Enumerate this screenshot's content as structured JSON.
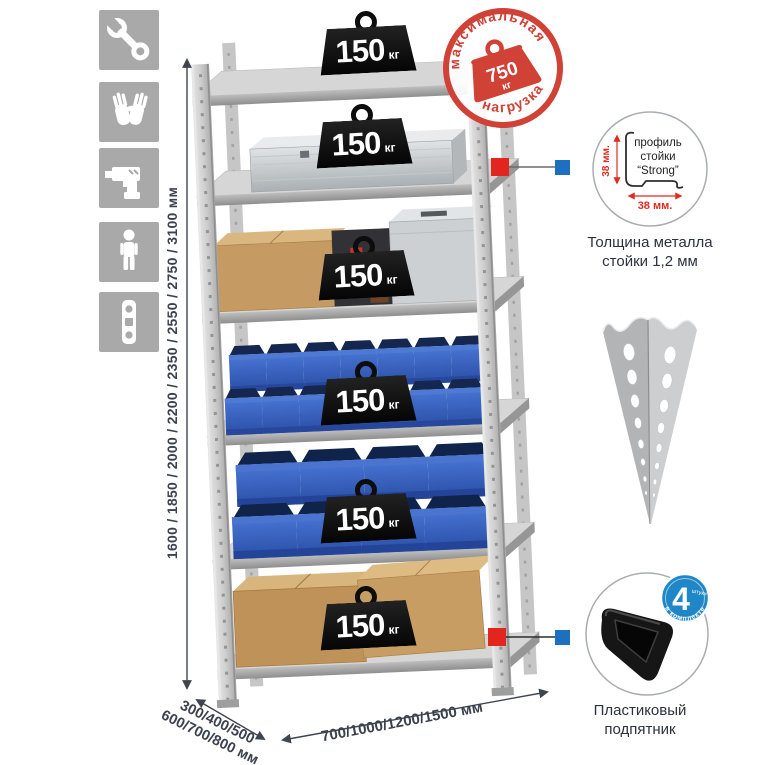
{
  "feature_icons": [
    {
      "name": "wrench-icon"
    },
    {
      "name": "gloves-icon"
    },
    {
      "name": "drill-icon"
    },
    {
      "name": "person-icon"
    },
    {
      "name": "level-icon"
    }
  ],
  "dimensions": {
    "height_label": "1600 / 1850 / 2000 / 2200 / 2350 / 2550 / 2750 / 3100 мм",
    "depth_label_line1": "300/400/500",
    "depth_label_line2": "600/700/800 мм",
    "width_label": "700/1000/1200/1500 мм"
  },
  "max_load_stamp": {
    "arc_top": "максимальная",
    "arc_bottom": "нагрузка",
    "value": "750",
    "unit": "кг"
  },
  "shelves": [
    {
      "load": "150",
      "unit": "кг"
    },
    {
      "load": "150",
      "unit": "кг"
    },
    {
      "load": "150",
      "unit": "кг"
    },
    {
      "load": "150",
      "unit": "кг"
    },
    {
      "load": "150",
      "unit": "кг"
    },
    {
      "load": "150",
      "unit": "кг"
    }
  ],
  "profile_detail": {
    "dim_vertical": "38 мм.",
    "dim_horizontal": "38 мм.",
    "line1": "профиль",
    "line2": "стойки",
    "line3": "“Strong”",
    "caption_line1": "Толщина металла",
    "caption_line2": "стойки 1,2 мм"
  },
  "foot_detail": {
    "badge_number": "4",
    "badge_word": "штуки",
    "badge_arc": "в комплекте",
    "caption_line1": "Пластиковый",
    "caption_line2": "подпятник"
  },
  "colors": {
    "stamp_red": "#d04136",
    "marker_red": "#e3251f",
    "marker_blue": "#1d6fc0",
    "badge_blue": "#1f86c8",
    "bin_blue": "#3a6ac6",
    "icon_gray": "#a9a9a9",
    "metal_gray": "#c9c9c9",
    "text_dark": "#353b46"
  }
}
